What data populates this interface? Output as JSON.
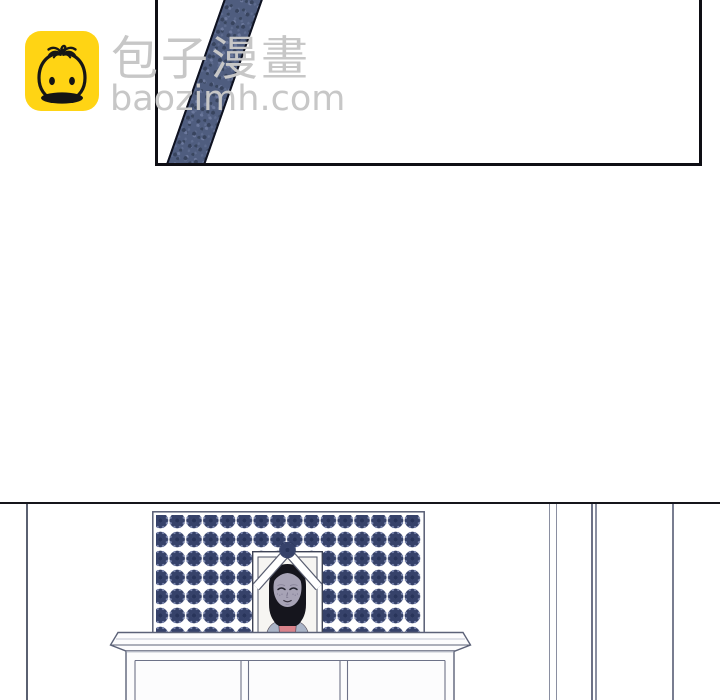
{
  "watermark": {
    "brand_cjk": "包子漫畫",
    "brand_domain": "baozimh.com",
    "icon": "baozi-bun-icon",
    "icon_bg_color": "#ffd414",
    "text_color": "#c7c7c7"
  },
  "panel": {
    "description": "empty white comic panel crossed by a diagonal dark-blue pole",
    "border_color": "#0e0e14",
    "pole_fill_color": "#4f5d7f",
    "pole_edge_color": "#0f1220"
  },
  "scene": {
    "description": "memorial altar: rosette-patterned folding screen, framed funeral portrait with white ribbon, long wooden cabinet",
    "divider_line_color": "#15151b",
    "wall_line_color": "#8a8fa1",
    "screen": {
      "pattern": "rosette-flower-grid",
      "pattern_color": "#4f5a82",
      "background": "#ffffff"
    },
    "portrait": {
      "subject": "memorial-photo-of-person",
      "ribbon_color": "#ffffff",
      "hair_color": "#15151d",
      "skin_color": "#a7a3b6",
      "shirt_color": "#d9828b",
      "cardigan_color": "#aab4c7",
      "photo_bg": "#f6f5f2"
    },
    "cabinet": {
      "fill": "#fcfcfd",
      "line_color": "#5c6278",
      "panel_count": 3
    }
  }
}
